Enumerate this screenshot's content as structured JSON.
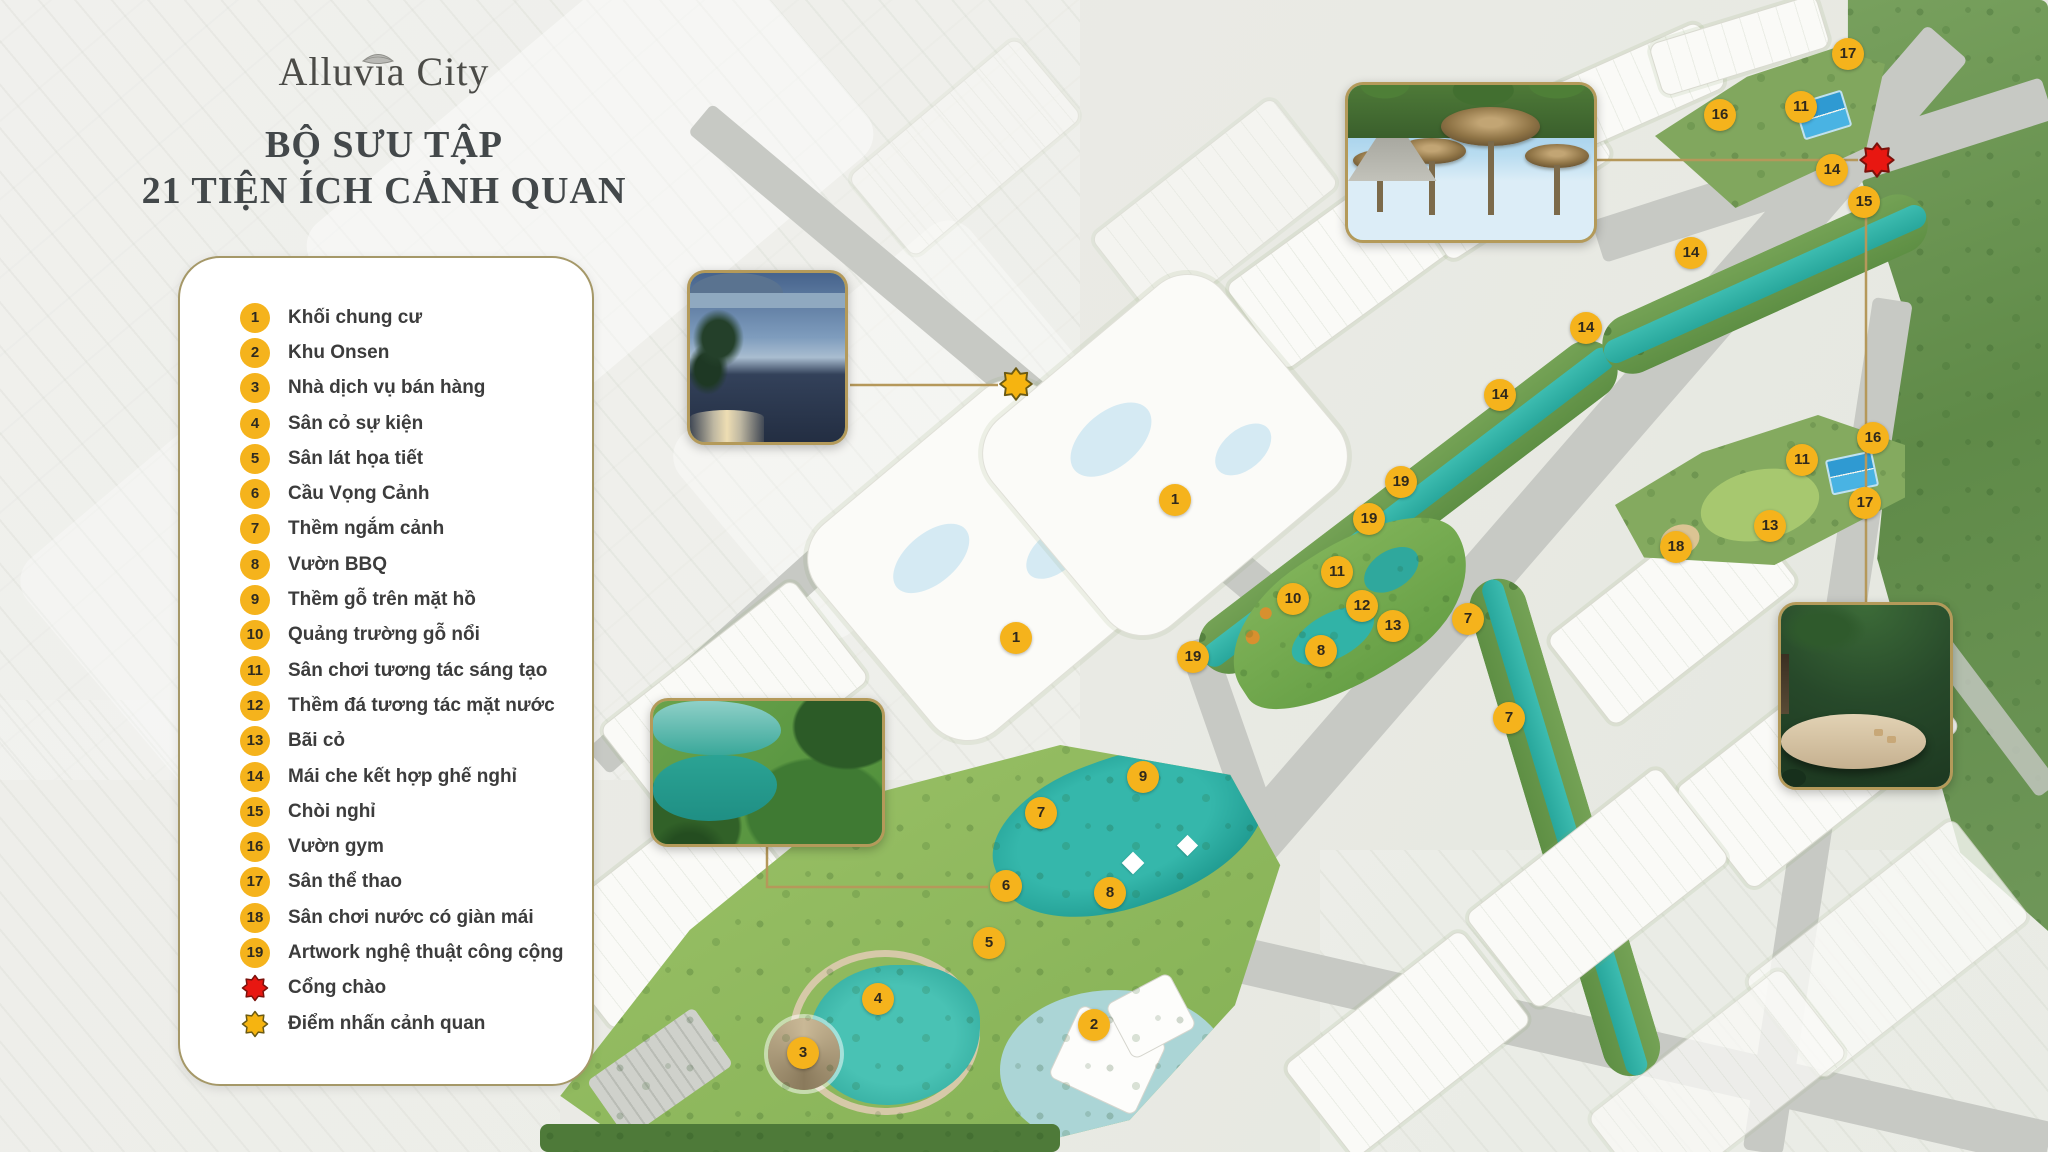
{
  "brand": {
    "logo_text": "Alluvia City"
  },
  "title": {
    "line1": "BỘ SƯU TẬP",
    "line2": "21 TIỆN ÍCH CẢNH QUAN"
  },
  "legend": {
    "items": [
      {
        "num": "1",
        "label": "Khối chung cư"
      },
      {
        "num": "2",
        "label": "Khu Onsen"
      },
      {
        "num": "3",
        "label": "Nhà dịch vụ bán hàng"
      },
      {
        "num": "4",
        "label": "Sân cỏ sự kiện"
      },
      {
        "num": "5",
        "label": "Sân lát họa tiết"
      },
      {
        "num": "6",
        "label": "Cầu Vọng Cảnh"
      },
      {
        "num": "7",
        "label": "Thềm ngắm cảnh"
      },
      {
        "num": "8",
        "label": "Vườn BBQ"
      },
      {
        "num": "9",
        "label": "Thềm gỗ trên mặt hồ"
      },
      {
        "num": "10",
        "label": "Quảng trường gỗ nổi"
      },
      {
        "num": "11",
        "label": "Sân chơi tương tác sáng tạo"
      },
      {
        "num": "12",
        "label": "Thềm đá tương tác mặt nước"
      },
      {
        "num": "13",
        "label": "Bãi cỏ"
      },
      {
        "num": "14",
        "label": "Mái che kết hợp ghế nghỉ"
      },
      {
        "num": "15",
        "label": "Chòi nghỉ"
      },
      {
        "num": "16",
        "label": "Vườn gym"
      },
      {
        "num": "17",
        "label": "Sân thể thao"
      },
      {
        "num": "18",
        "label": "Sân chơi nước có giàn mái"
      },
      {
        "num": "19",
        "label": "Artwork nghệ thuật công cộng"
      }
    ],
    "special": [
      {
        "type": "red-star",
        "label": "Cổng chào",
        "color": "#e81711"
      },
      {
        "type": "yellow-star",
        "label": "Điểm nhấn cảnh quan",
        "color": "#f6b410"
      }
    ]
  },
  "map": {
    "markers": [
      {
        "n": "17",
        "x": 1848,
        "y": 54
      },
      {
        "n": "16",
        "x": 1720,
        "y": 115
      },
      {
        "n": "11",
        "x": 1801,
        "y": 107
      },
      {
        "n": "14",
        "x": 1832,
        "y": 170
      },
      {
        "n": "15",
        "x": 1864,
        "y": 202
      },
      {
        "n": "14",
        "x": 1691,
        "y": 253
      },
      {
        "n": "14",
        "x": 1586,
        "y": 328
      },
      {
        "n": "14",
        "x": 1500,
        "y": 395
      },
      {
        "n": "19",
        "x": 1401,
        "y": 482
      },
      {
        "n": "19",
        "x": 1369,
        "y": 519
      },
      {
        "n": "16",
        "x": 1873,
        "y": 438
      },
      {
        "n": "11",
        "x": 1802,
        "y": 460
      },
      {
        "n": "17",
        "x": 1865,
        "y": 503
      },
      {
        "n": "13",
        "x": 1770,
        "y": 526
      },
      {
        "n": "18",
        "x": 1676,
        "y": 547
      },
      {
        "n": "11",
        "x": 1337,
        "y": 572
      },
      {
        "n": "10",
        "x": 1293,
        "y": 599
      },
      {
        "n": "12",
        "x": 1362,
        "y": 606
      },
      {
        "n": "13",
        "x": 1393,
        "y": 626
      },
      {
        "n": "7",
        "x": 1468,
        "y": 619
      },
      {
        "n": "8",
        "x": 1321,
        "y": 651
      },
      {
        "n": "19",
        "x": 1193,
        "y": 657
      },
      {
        "n": "1",
        "x": 1175,
        "y": 500
      },
      {
        "n": "1",
        "x": 1016,
        "y": 638
      },
      {
        "n": "7",
        "x": 1509,
        "y": 718
      },
      {
        "n": "9",
        "x": 1143,
        "y": 777
      },
      {
        "n": "7",
        "x": 1041,
        "y": 813
      },
      {
        "n": "6",
        "x": 1006,
        "y": 886
      },
      {
        "n": "8",
        "x": 1110,
        "y": 893
      },
      {
        "n": "5",
        "x": 989,
        "y": 943
      },
      {
        "n": "4",
        "x": 878,
        "y": 999
      },
      {
        "n": "2",
        "x": 1094,
        "y": 1025
      },
      {
        "n": "3",
        "x": 803,
        "y": 1053
      }
    ],
    "stars": [
      {
        "type": "red-star",
        "x": 1877,
        "y": 160,
        "color": "#e81711",
        "size": 40
      },
      {
        "type": "yellow-star",
        "x": 1016,
        "y": 384,
        "color": "#f6b410",
        "size": 38
      }
    ],
    "insets": [
      {
        "id": "gate",
        "name": "entrance-gate-photo",
        "x": 1345,
        "y": 82,
        "w": 252,
        "h": 161
      },
      {
        "id": "fountain",
        "name": "fountain-photo",
        "x": 687,
        "y": 270,
        "w": 161,
        "h": 175
      },
      {
        "id": "lake",
        "name": "lake-bridge-photo",
        "x": 650,
        "y": 698,
        "w": 235,
        "h": 149
      },
      {
        "id": "pavilion",
        "name": "pavilion-photo",
        "x": 1778,
        "y": 602,
        "w": 175,
        "h": 188
      }
    ],
    "connectors": [
      {
        "points": [
          [
            1597,
            160
          ],
          [
            1858,
            160
          ]
        ]
      },
      {
        "points": [
          [
            850,
            385
          ],
          [
            998,
            385
          ]
        ]
      },
      {
        "points": [
          [
            767,
            845
          ],
          [
            767,
            887
          ],
          [
            988,
            887
          ]
        ]
      },
      {
        "points": [
          [
            1866,
            604
          ],
          [
            1866,
            216
          ]
        ]
      }
    ]
  },
  "colors": {
    "gold": "#b5985a",
    "badge_yellow": "#f5b31c",
    "red_star": "#e81711",
    "yellow_star": "#f6b410",
    "canal_teal": "#2fb3a8",
    "park_green": "#8fbe5f",
    "forest_green": "#6f9656"
  }
}
